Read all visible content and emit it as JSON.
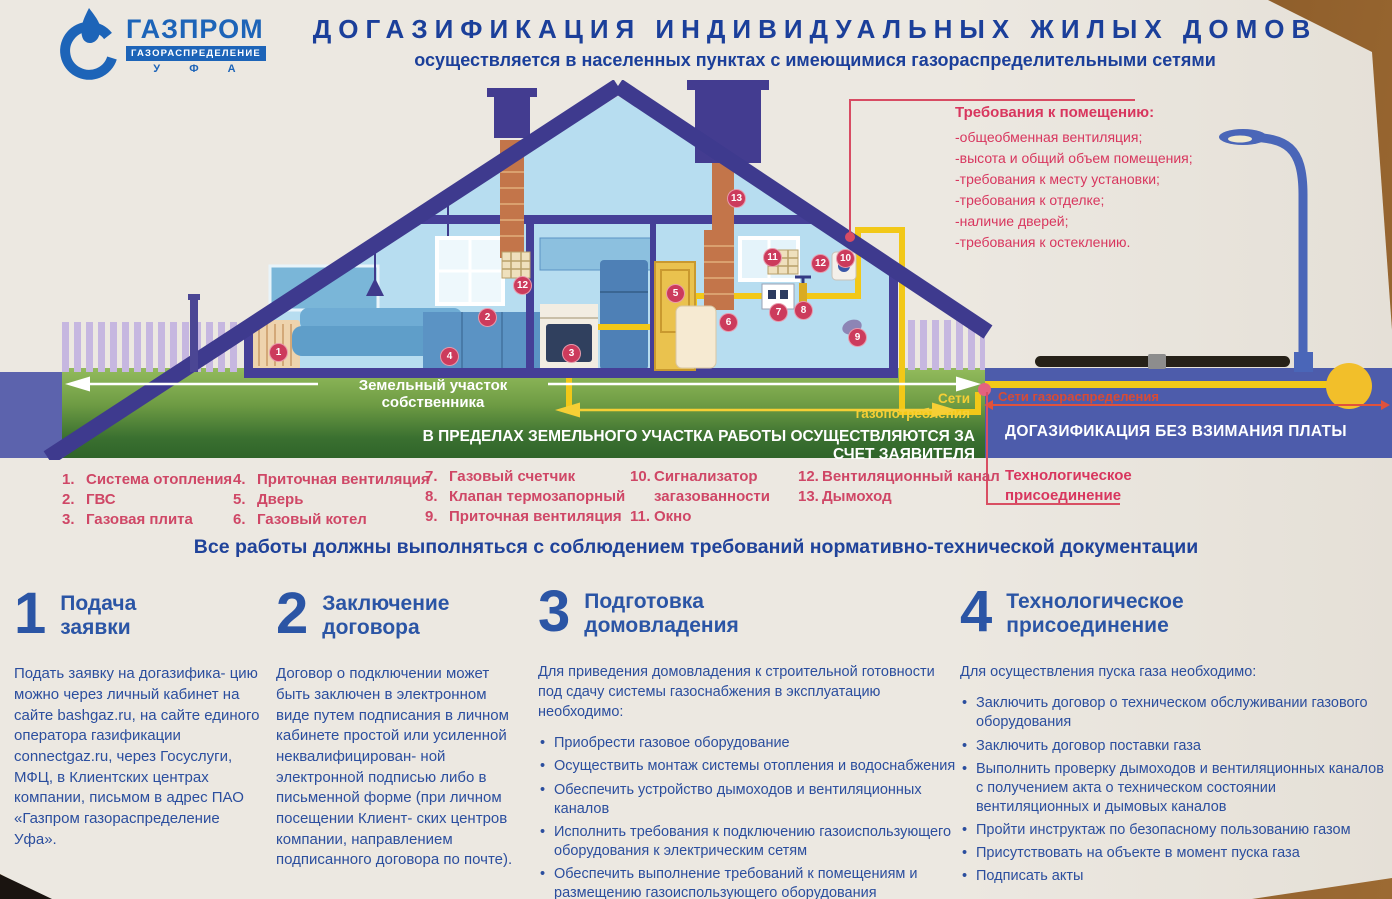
{
  "header": {
    "logo": {
      "name": "ГАЗПРОМ",
      "sub": "ГАЗОРАСПРЕДЕЛЕНИЕ",
      "city": "У Ф А"
    },
    "title": "ДОГАЗИФИКАЦИЯ ИНДИВИДУАЛЬНЫХ ЖИЛЫХ ДОМОВ",
    "subtitle": "осуществляется в населенных пунктах с имеющимися газораспределительными сетями"
  },
  "requirements": {
    "title": "Требования к помещению:",
    "items": [
      "-общеобменная вентиляция;",
      "-высота и общий объем помещения;",
      "-требования к месту установки;",
      "-требования к отделке;",
      "-наличие дверей;",
      "-требования к остеклению."
    ]
  },
  "diagram": {
    "land_label": "Земельный участок собственника",
    "land_banner": "В ПРЕДЕЛАХ ЗЕМЕЛЬНОГО УЧАСТКА РАБОТЫ ОСУЩЕСТВЛЯЮТСЯ ЗА СЧЕТ ЗАЯВИТЕЛЯ",
    "gas_consumption_label": "Сети газопотребления",
    "gas_distribution_label": "Сети газораспределения",
    "free_banner": "ДОГАЗИФИКАЦИЯ БЕЗ ВЗИМАНИЯ ПЛАТЫ",
    "markers": {
      "m1": "1",
      "m2": "2",
      "m3": "3",
      "m4": "4",
      "m5": "5",
      "m6": "6",
      "m7": "7",
      "m8": "8",
      "m9": "9",
      "m10": "10",
      "m11": "11",
      "m12": "12",
      "m13": "13"
    },
    "colors": {
      "accent_red": "#d8365e",
      "gas_yellow": "#f2c818",
      "lawn_green": "#5d8f3c",
      "road_blue": "#4d5cab",
      "house_purple": "#453f97",
      "text_blue": "#2b55a5"
    }
  },
  "legend": {
    "items": [
      {
        "num": "1.",
        "label": "Система отопления"
      },
      {
        "num": "2.",
        "label": "ГВС"
      },
      {
        "num": "3.",
        "label": "Газовая плита"
      },
      {
        "num": "4.",
        "label": "Приточная вентиляция"
      },
      {
        "num": "5.",
        "label": "Дверь"
      },
      {
        "num": "6.",
        "label": "Газовый котел"
      },
      {
        "num": "7.",
        "label": "Газовый счетчик"
      },
      {
        "num": "8.",
        "label": "Клапан термозапорный"
      },
      {
        "num": "9.",
        "label": "Приточная вентиляция"
      },
      {
        "num": "10.",
        "label": "Сигнализатор загазованности"
      },
      {
        "num": "11.",
        "label": "Окно"
      },
      {
        "num": "12.",
        "label": "Вентиляционный канал"
      },
      {
        "num": "13.",
        "label": "Дымоход"
      }
    ],
    "extra": "Технологическое присоединение"
  },
  "notice": "Все работы должны выполняться с соблюдением требований нормативно-технической документации",
  "steps": [
    {
      "num": "1",
      "title_1": "Подача",
      "title_2": "заявки",
      "body": "Подать заявку на догазифика- цию можно через личный кабинет на сайте bashgaz.ru, на сайте единого оператора газификации connectgaz.ru, через Госуслуги, МФЦ, в Клиентских центрах компании, письмом в адрес ПАО «Газпром газораспределение Уфа»."
    },
    {
      "num": "2",
      "title_1": "Заключение",
      "title_2": "договора",
      "body": "Договор о подключении может быть заключен в электронном виде путем подписания в личном кабинете простой или усиленной неквалифицирован- ной электронной подписью либо в письменной форме (при личном посещении Клиент- ских центров компании, направлением подписанного договора по почте)."
    },
    {
      "num": "3",
      "title_1": "Подготовка",
      "title_2": "домовладения",
      "intro": "Для приведения домовладения к строительной готовности под сдачу системы газоснабжения в эксплуатацию необходимо:",
      "bullets": [
        "Приобрести газовое оборудование",
        "Осуществить монтаж системы отопления и водоснабжения",
        "Обеспечить устройство дымоходов и вентиляционных каналов",
        "Исполнить требования к подключению газоиспользующего оборудования к электрическим сетям",
        "Обеспечить выполнение требований к помещениям и размещению газоиспользующего оборудования"
      ]
    },
    {
      "num": "4",
      "title_1": "Технологическое",
      "title_2": "присоединение",
      "intro": "Для осуществления пуска газа необходимо:",
      "bullets": [
        "Заключить договор о техническом обслуживании газового оборудования",
        "Заключить договор поставки газа",
        "Выполнить проверку дымоходов и вентиляционных каналов с получением акта о техническом состоянии вентиляционных и дымовых каналов",
        "Пройти инструктаж по безопасному пользованию газом",
        "Присутствовать на объекте в момент пуска газа",
        "Подписать акты"
      ]
    }
  ]
}
